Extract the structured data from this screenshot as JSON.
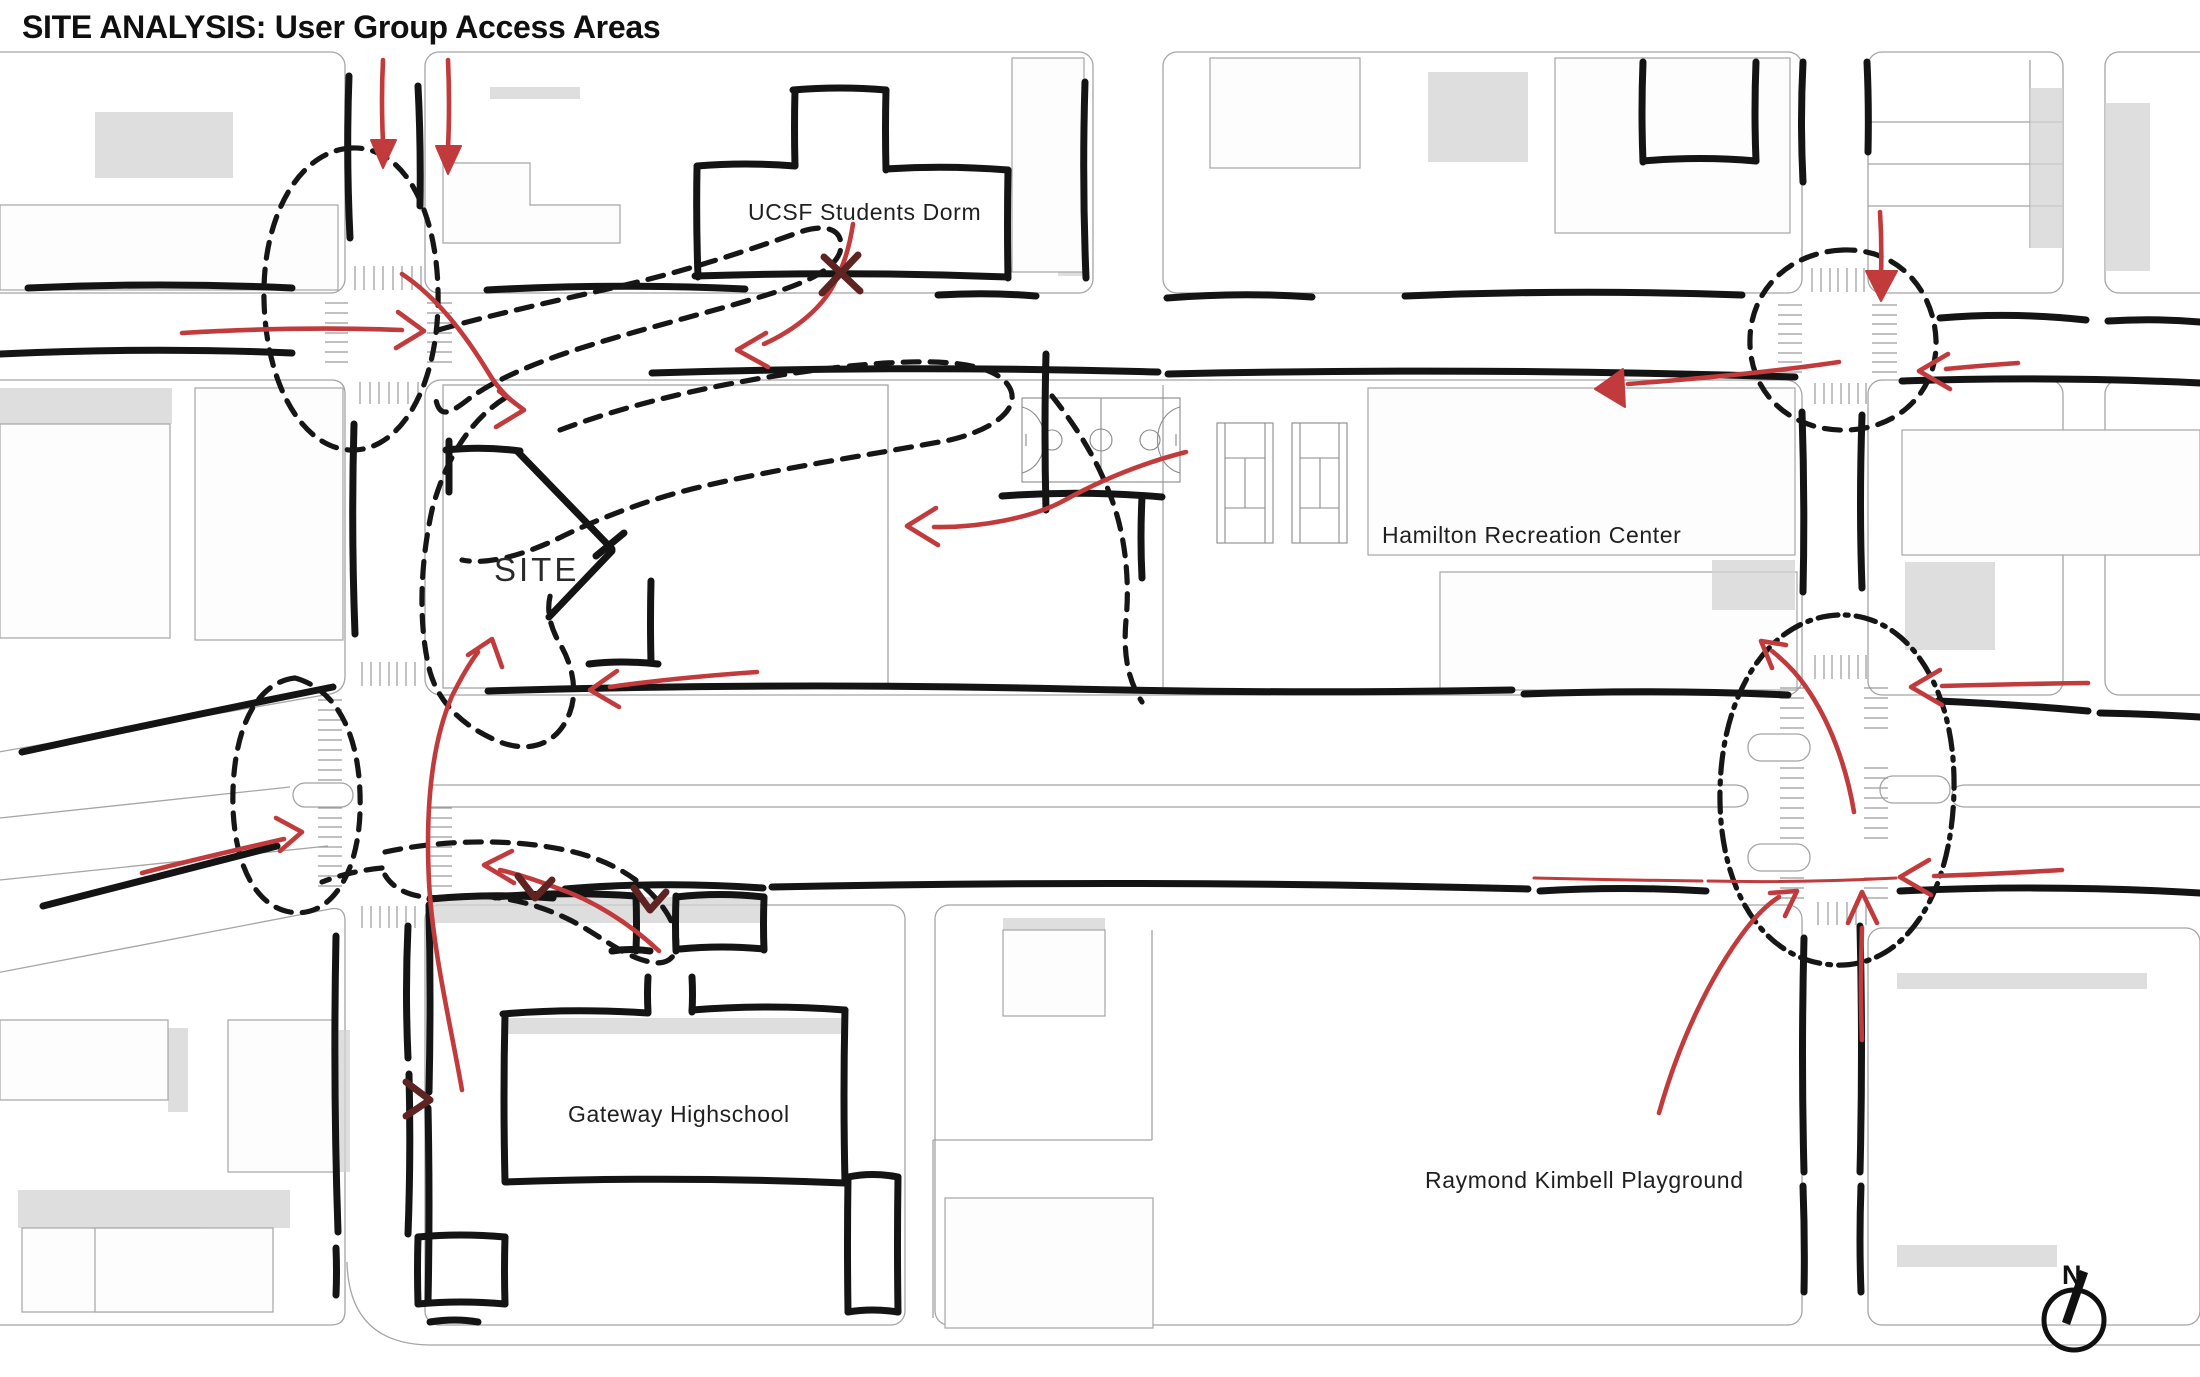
{
  "title": "SITE ANALYSIS: User Group Access Areas",
  "map": {
    "labels": {
      "dorm": "UCSF Students Dorm",
      "recreation_center": "Hamilton Recreation Center",
      "site": "SITE",
      "school": "Gateway Highschool",
      "playground": "Raymond Kimbell Playground"
    },
    "compass": {
      "north_label": "N"
    }
  },
  "icons": {
    "north_arrow": "compass-north-icon"
  },
  "colors": {
    "arrow_red": "#c23b3c",
    "arrow_dark_red": "#5e2422",
    "sketch_black": "#141414",
    "bubble_black": "#161616",
    "parcel_line": "#a5a5a5",
    "court_line": "#8a8a8a",
    "shadow_gray": "#d3d3d3"
  }
}
